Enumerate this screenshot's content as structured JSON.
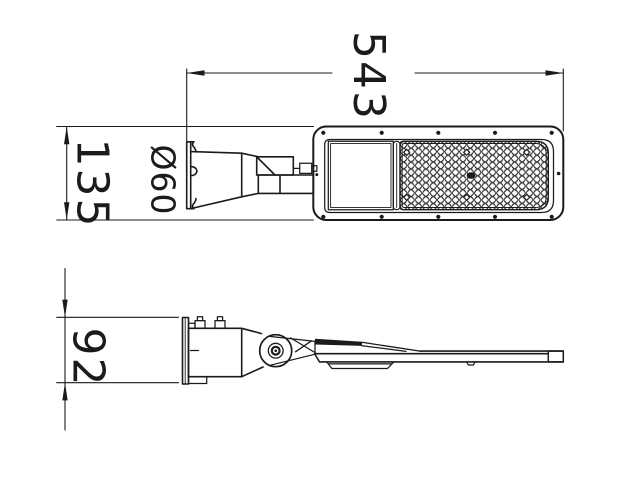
{
  "drawing": {
    "type": "technical-drawing",
    "subject": "led-street-light",
    "colors": {
      "background": "#ffffff",
      "line": "#1b1b1b"
    },
    "dimensions": {
      "overall_length": {
        "value": "543"
      },
      "head_width": {
        "value": "135"
      },
      "pole_diameter": {
        "value": "Ø60"
      },
      "mount_height": {
        "value": "92"
      }
    }
  }
}
